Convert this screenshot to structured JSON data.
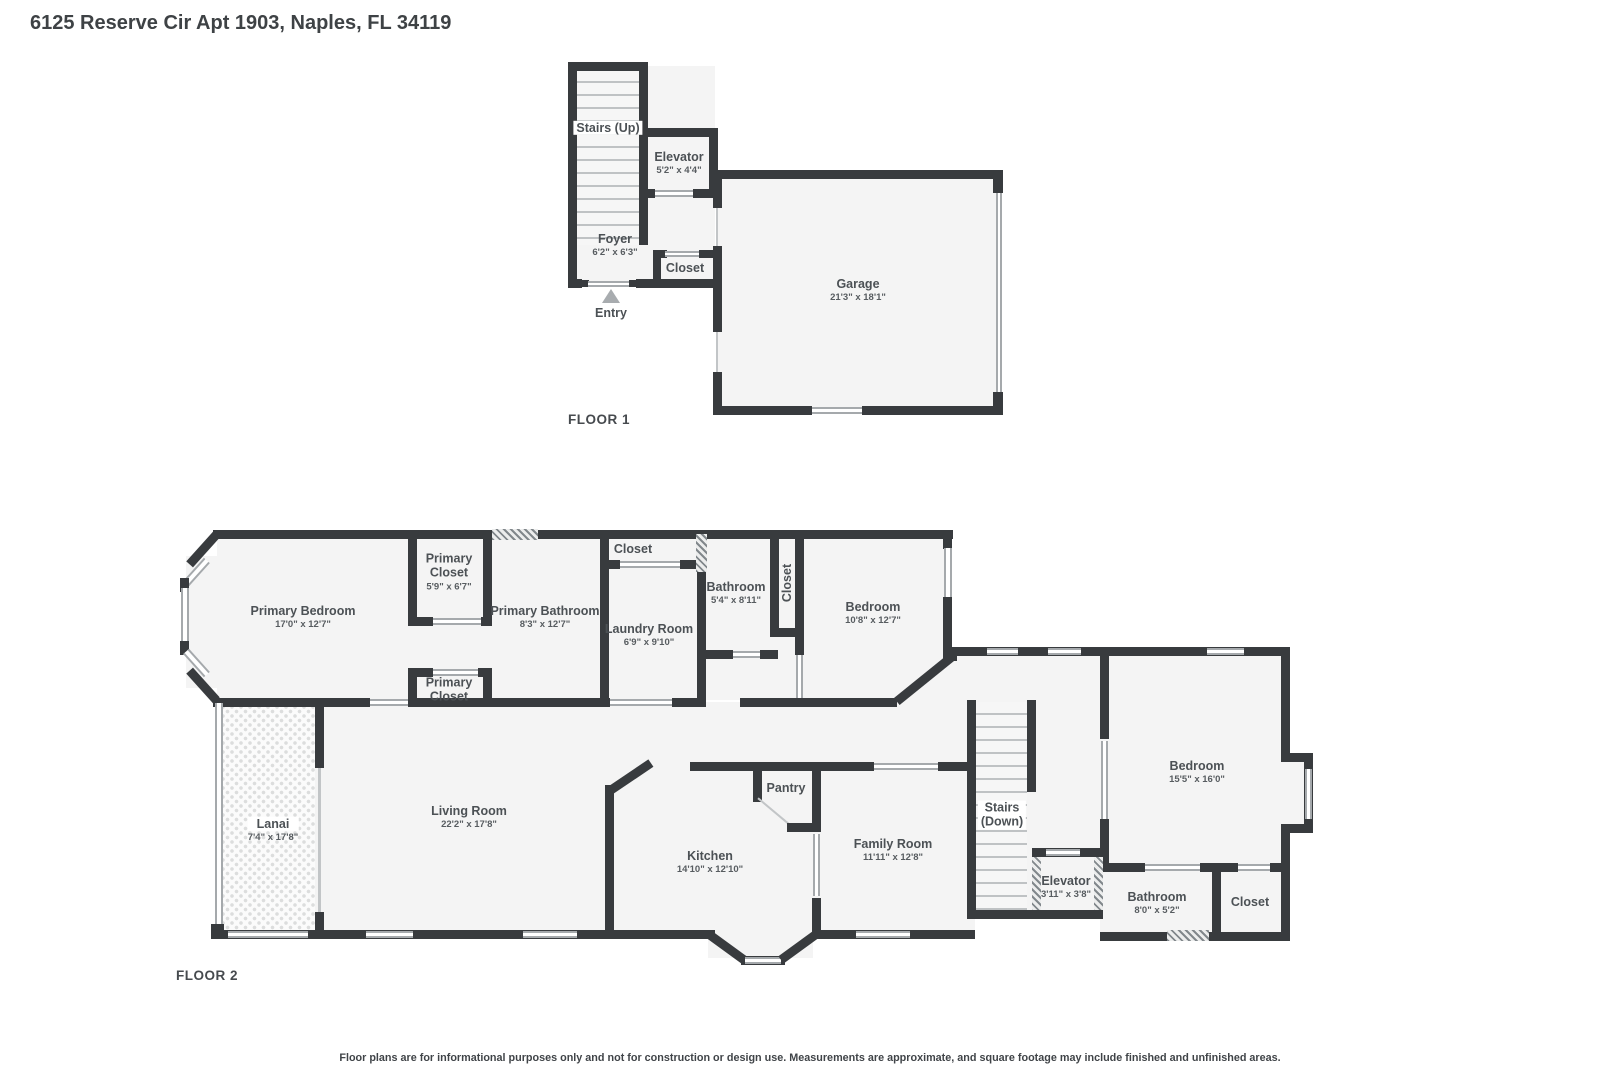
{
  "title": "6125 Reserve Cir Apt 1903, Naples, FL 34119",
  "disclaimer": "Floor plans are for informational purposes only and not for construction or design use. Measurements are approximate, and square footage may include finished and unfinished areas.",
  "floor1": {
    "label": "FLOOR 1",
    "rooms": {
      "stairs": {
        "name": "Stairs (Up)"
      },
      "elevator": {
        "name": "Elevator",
        "dims": "5'2\" x 4'4\""
      },
      "foyer": {
        "name": "Foyer",
        "dims": "6'2\" x 6'3\""
      },
      "closet": {
        "name": "Closet"
      },
      "entry": {
        "name": "Entry"
      },
      "garage": {
        "name": "Garage",
        "dims": "21'3\" x 18'1\""
      }
    }
  },
  "floor2": {
    "label": "FLOOR 2",
    "rooms": {
      "primary_bedroom": {
        "name": "Primary Bedroom",
        "dims": "17'0\" x 12'7\""
      },
      "primary_closet_upper": {
        "name": "Primary Closet",
        "dims": "5'9\" x 6'7\""
      },
      "primary_bathroom": {
        "name": "Primary Bathroom",
        "dims": "8'3\" x 12'7\""
      },
      "primary_closet_lower": {
        "name": "Primary Closet"
      },
      "closet_top": {
        "name": "Closet"
      },
      "laundry": {
        "name": "Laundry Room",
        "dims": "6'9\" x 9'10\""
      },
      "bathroom_small": {
        "name": "Bathroom",
        "dims": "5'4\" x 8'11\""
      },
      "closet_vertical": {
        "name": "Closet"
      },
      "bedroom_mid": {
        "name": "Bedroom",
        "dims": "10'8\" x 12'7\""
      },
      "lanai": {
        "name": "Lanai",
        "dims": "7'4\" x 17'8\""
      },
      "living_room": {
        "name": "Living Room",
        "dims": "22'2\" x 17'8\""
      },
      "kitchen": {
        "name": "Kitchen",
        "dims": "14'10\" x 12'10\""
      },
      "pantry": {
        "name": "Pantry"
      },
      "family_room": {
        "name": "Family Room",
        "dims": "11'11\" x 12'8\""
      },
      "stairs": {
        "name": "Stairs",
        "name2": "(Down)"
      },
      "elevator": {
        "name": "Elevator",
        "dims": "3'11\" x 3'8\""
      },
      "bedroom_right": {
        "name": "Bedroom",
        "dims": "15'5\" x 16'0\""
      },
      "bathroom_right": {
        "name": "Bathroom",
        "dims": "8'0\" x 5'2\""
      },
      "closet_right": {
        "name": "Closet"
      }
    }
  }
}
